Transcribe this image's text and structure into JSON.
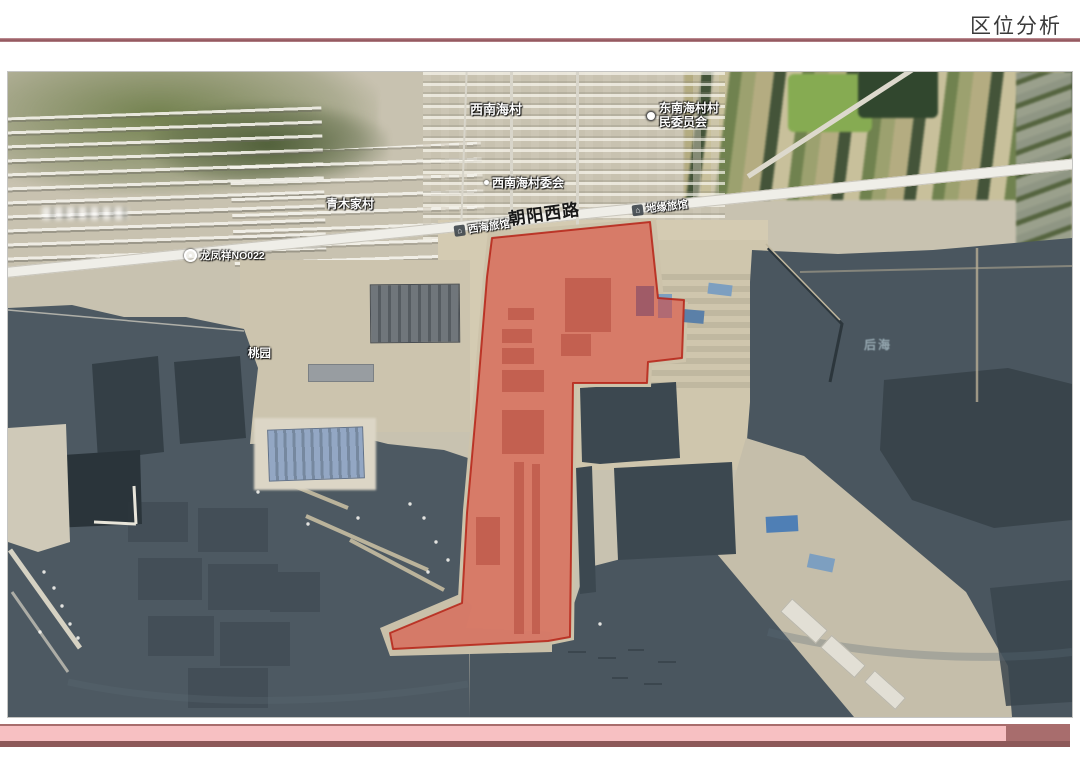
{
  "header": {
    "title": "区位分析"
  },
  "map": {
    "labels": {
      "village_nw": "西南海村",
      "committee_ne": {
        "line1": "东南海村村",
        "line2": "民委员会"
      },
      "committee_w": "西南海村委会",
      "village_qingmu": "青木家村",
      "road_main": "朝阳西路",
      "hotel_west": "西海旅馆",
      "hotel_east": "地缘旅馆",
      "shop_roadside": "龙凤祥NO022",
      "orchard": "桃园",
      "sea_area": "后海"
    },
    "highlight": {
      "fill": "#e03a2c",
      "stroke": "#b51f12"
    }
  },
  "theme": {
    "rule_color": "#96595f",
    "footer_pink": "#f7c0c2",
    "footer_mauve": "#a86d6d",
    "footer_dark_strip": "#8d5959",
    "sea_color": "#4c5861",
    "land_color": "#c8c2b0"
  }
}
